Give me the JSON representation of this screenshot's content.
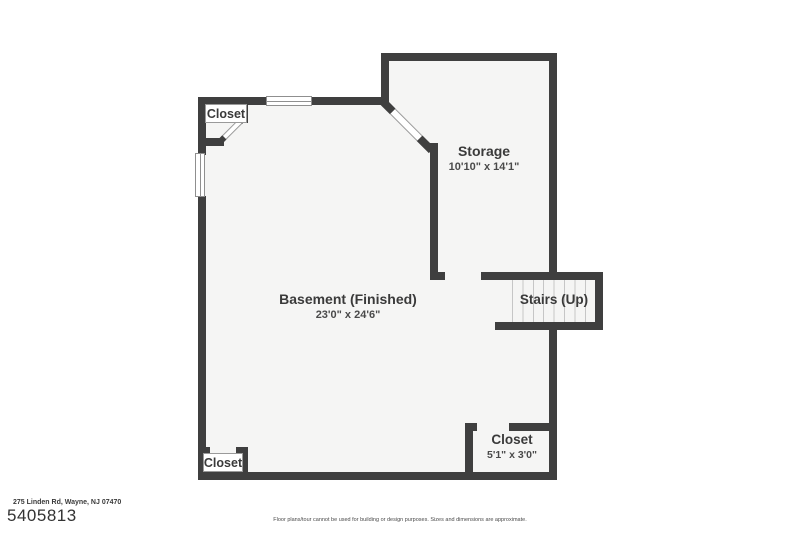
{
  "floorplan": {
    "rooms": {
      "closet_top_left": {
        "label": "Closet"
      },
      "storage": {
        "label": "Storage",
        "dimensions": "10'10\" x 14'1\""
      },
      "basement": {
        "label": "Basement (Finished)",
        "dimensions": "23'0\" x 24'6\""
      },
      "stairs": {
        "label": "Stairs (Up)"
      },
      "closet_bottom_right": {
        "label": "Closet",
        "dimensions": "5'1\" x 3'0\""
      },
      "closet_bottom_left": {
        "label": "Closet"
      }
    },
    "colors": {
      "wall": "#3f3f3f",
      "floor": "#f5f5f4",
      "stair_line": "#c6c6c6",
      "text": "#3a3a3a"
    }
  },
  "footer": {
    "address": "275 Linden Rd, Wayne, NJ 07470",
    "listing_id": "5405813",
    "disclaimer": "Floor plans/tour cannot be used for building or design purposes. Sizes and dimensions are approximate."
  }
}
